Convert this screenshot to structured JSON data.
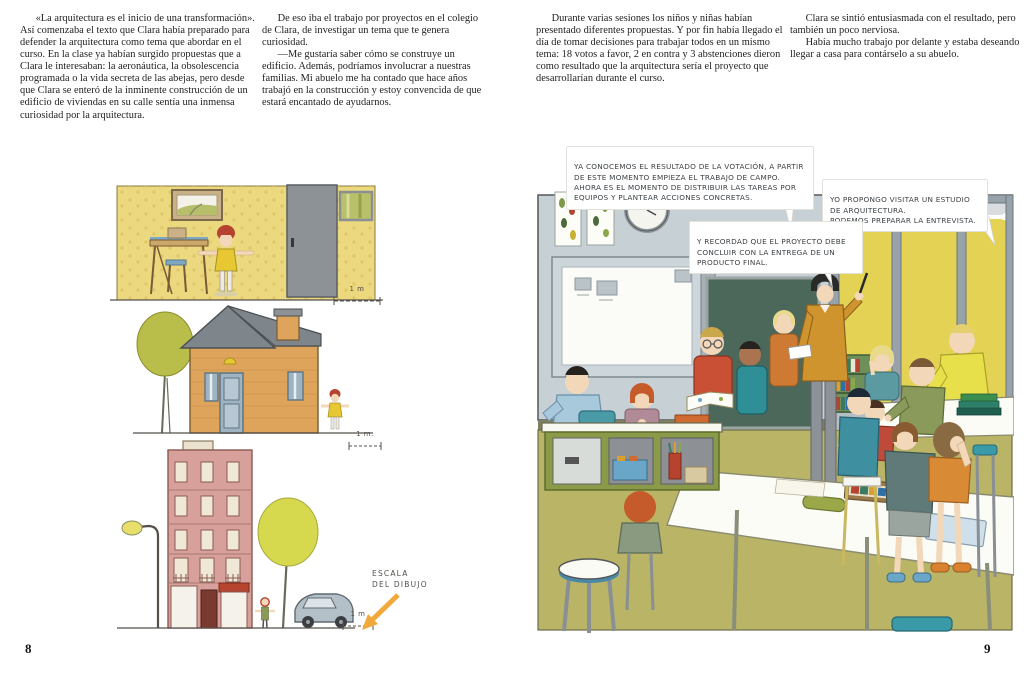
{
  "left_page": {
    "page_number": "8",
    "column1": {
      "p1": "«La arquitectura es el inicio de una transformación». Así comenzaba el texto que Clara había preparado para defender la arquitectura como tema que abordar en el curso. En la clase ya habían surgido propuestas que a Clara le interesaban: la aeronáutica, la obsolescencia programada o la vida secreta de las abejas, pero desde que Clara se enteró de la inminente construcción de un edificio de viviendas en su calle sentía una inmensa curiosidad por la arquitectura."
    },
    "column2": {
      "p1": "De eso iba el trabajo por proyectos en el colegio de Clara, de investigar un tema que te genera curiosidad.",
      "p2": "—Me gustaría saber cómo se construye un edificio. Además, podríamos involucrar a nuestras familias. Mi abuelo me ha contado que hace años trabajó en la construcción y estoy convencida de que estará encantado de ayudarnos."
    },
    "scales": {
      "room_scale": "1 m",
      "house_scale": "1 m.",
      "building_scale": "1 m",
      "caption_line1": "ESCALA",
      "caption_line2": "DEL DIBUJO"
    }
  },
  "right_page": {
    "page_number": "9",
    "column1": {
      "p1": "Durante varias sesiones los niños y niñas habían presentado diferentes propuestas. Y por fin había llegado el día de tomar decisiones para trabajar todos en un mismo tema: 18 votos a favor, 2 en contra y 3 abstenciones dieron como resultado que la arquitectura sería el proyecto que desarrollarían durante el curso."
    },
    "column2": {
      "p1": "Clara se sintió entusiasmada con el resultado, pero también un poco nerviosa.",
      "p2": "Había mucho trabajo por delante y estaba deseando llegar a casa para contárselo a su abuelo."
    },
    "speech_bubbles": {
      "teacher_1": "YA CONOCEMOS EL RESULTADO DE LA VOTACIÓN, A PARTIR DE ESTE MOMENTO EMPIEZA EL TRABAJO DE CAMPO. AHORA ES EL MOMENTO DE DISTRIBUIR LAS TAREAS POR EQUIPOS Y PLANTEAR ACCIONES CONCRETAS.",
      "student": "YO PROPONGO VISITAR UN ESTUDIO DE ARQUITECTURA.\nPODEMOS PREPARAR LA ENTREVISTA.",
      "teacher_2": "Y RECORDAD QUE EL PROYECTO DEBE CONCLUIR CON LA ENTREGA DE UN PRODUCTO FINAL."
    }
  },
  "colors": {
    "wallpaper_yellow": "#ecd87e",
    "house_orange": "#dfa45c",
    "building_pink": "#d8a09b",
    "classroom_wall": "#c7d0d5",
    "chalkboard_green": "#4c685a",
    "floor_olive": "#b9b466",
    "window_trees_yellow": "#e4d254",
    "teacher_mustard": "#d0942f",
    "arrow_orange": "#f2a93b",
    "awning_red": "#b5452f"
  }
}
